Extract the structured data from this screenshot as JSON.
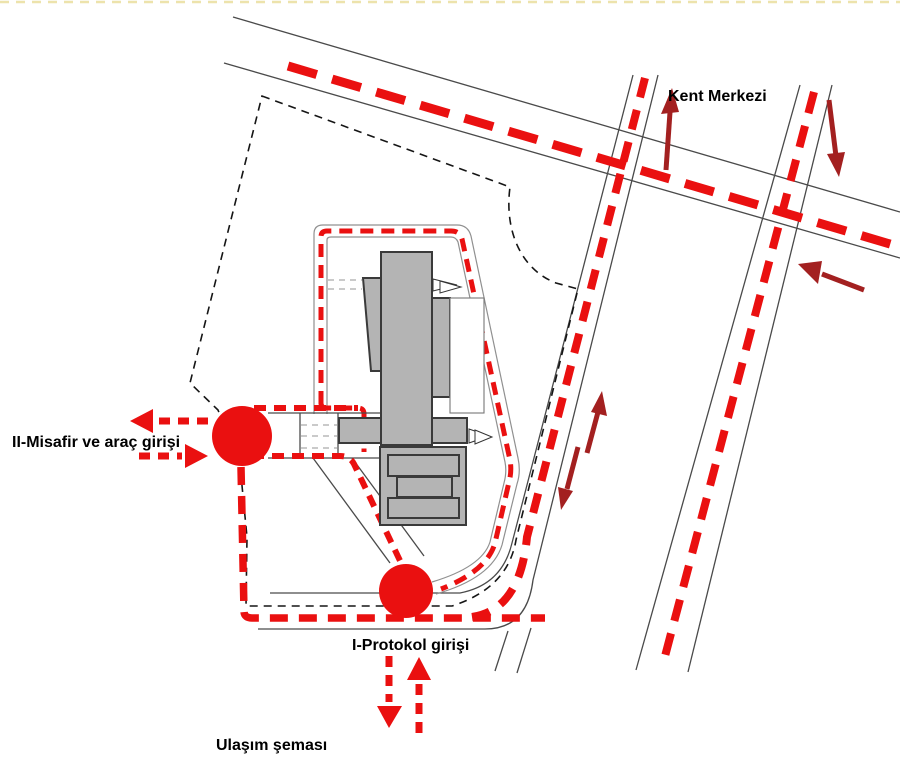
{
  "diagram": {
    "labels": {
      "city_center": "Kent Merkezi",
      "guest_vehicle_entrance": "II-Misafir ve araç girişi",
      "protocol_entrance": "I-Protokol girişi",
      "scheme_title": "Ulaşım şeması"
    },
    "colors": {
      "route_red": "#ea1010",
      "arrow_dark_red": "#a32020",
      "building_gray": "#b4b4b4",
      "building_outline": "#3a3a3a",
      "road_edge_gray": "#4a4a4a",
      "driveway_outline_gray": "#909090",
      "boundary_black": "#151515",
      "top_border_yellow": "#eadf9e",
      "background_white": "#ffffff"
    }
  }
}
